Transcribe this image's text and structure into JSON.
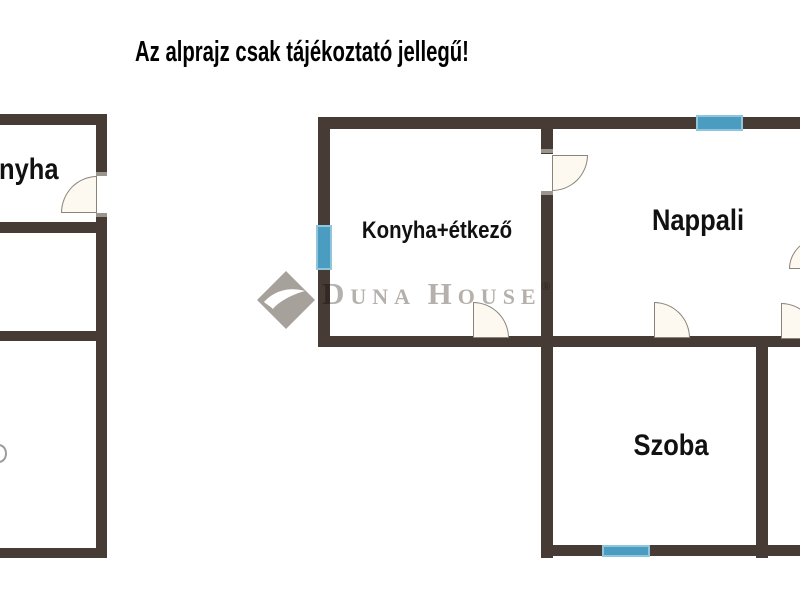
{
  "title": {
    "text": "Az alprajz csak tájékoztató jellegű!"
  },
  "watermark": {
    "initial_1": "D",
    "rest_1": "UNA",
    "initial_2": "H",
    "rest_2": "OUSE",
    "registered": "®"
  },
  "floorplan": {
    "left_unit": {
      "rooms": [
        {
          "label": "nyha"
        }
      ]
    },
    "right_unit": {
      "rooms": [
        {
          "label": "Konyha+étkező"
        },
        {
          "label": "Nappali"
        },
        {
          "label": "Szoba"
        }
      ]
    }
  },
  "colors": {
    "wall": "#473B35",
    "window": "#4A9CC0",
    "window_border": "#8FC6DB",
    "door_fill": "#FDF8F0",
    "door_stroke": "#8A8379",
    "watermark_gray": "#B5B0AB",
    "title_color": "#000000"
  }
}
